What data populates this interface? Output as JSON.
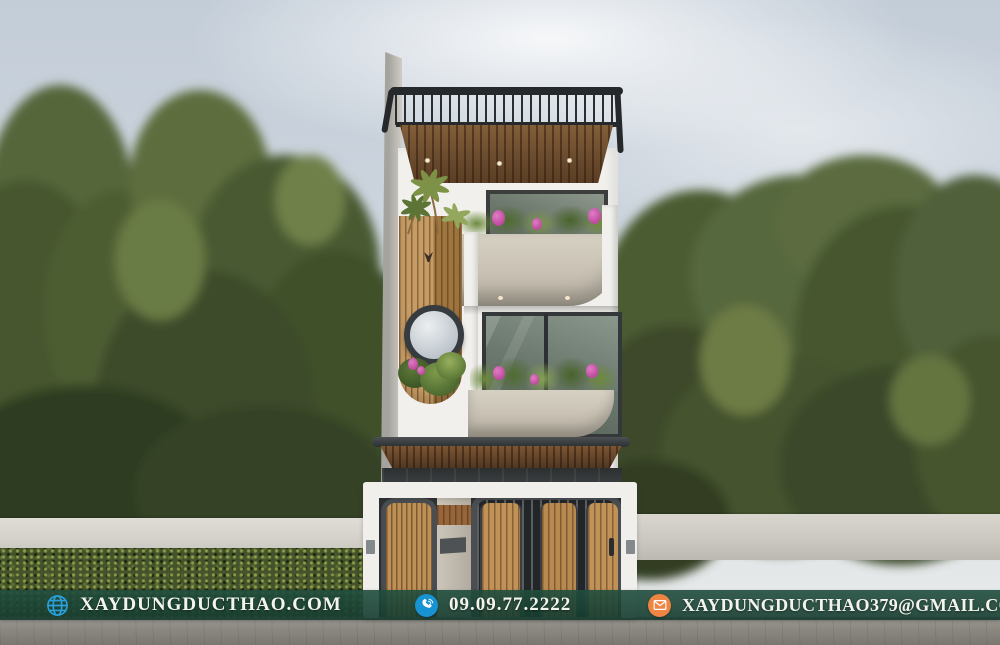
{
  "footer": {
    "website": {
      "icon": "globe-icon",
      "label": "XAYDUNGDUCTHAO.COM"
    },
    "phone": {
      "icon": "phone-icon",
      "label": "09.09.77.2222"
    },
    "email": {
      "icon": "email-icon",
      "label": "XAYDUNGDUCTHAO379@GMAIL.COM"
    },
    "colors": {
      "banner_bg": "#1d4a3b",
      "icon_blue": "#1793d3",
      "icon_orange": "#ee8542",
      "text": "#f4f4ee"
    }
  },
  "scene": {
    "subject": "modern-three-story-townhouse-facade",
    "elements": [
      "sky",
      "trees",
      "fence-wall",
      "hedge",
      "road",
      "rooftop-pergola",
      "wood-soffit",
      "balcony-planters",
      "round-porthole-window",
      "wood-slat-panel",
      "awning",
      "entry-gate"
    ]
  }
}
